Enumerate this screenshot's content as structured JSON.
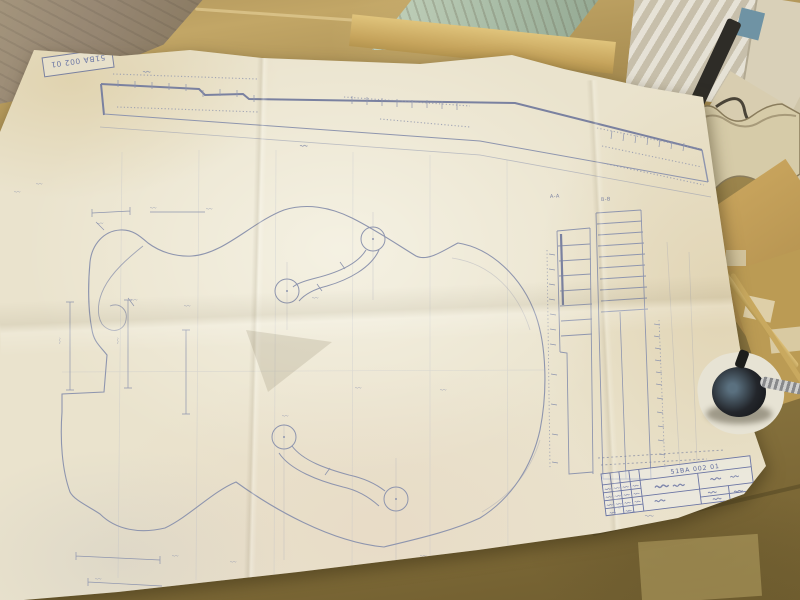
{
  "scene": {
    "setting": "workshop bench with wood pieces",
    "objects": [
      "blueprint sheet",
      "wooden bench",
      "gray board",
      "pale green painted plank",
      "plastic bag",
      "black binding strip",
      "white wood templates",
      "wavy-edged template",
      "thin wood sticks",
      "tape patches",
      "clamp screw with black knob"
    ]
  },
  "blueprint": {
    "subject": "archtop guitar full-scale drawing with two f-holes, side profile and section details",
    "stamp_text": "51BA 002 01",
    "title_block": {
      "doc_number": "51BA 002 01"
    },
    "section_labels": [
      "A-A",
      "B-B"
    ]
  },
  "colors": {
    "paper": "#eae3cd",
    "pencil_ink": "#8e95ae",
    "pencil_ink_dark": "#7a81a0",
    "title_ink": "#5f6b9e",
    "bench_wood": "#97814a",
    "green_plank": "#b0c0aa",
    "knob_black": "#1d1f22"
  }
}
